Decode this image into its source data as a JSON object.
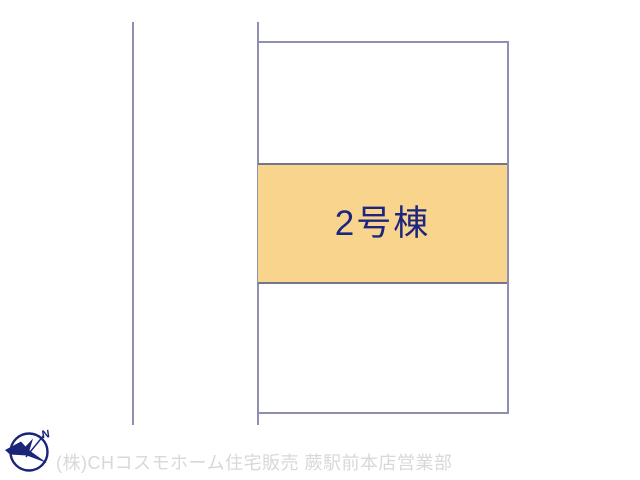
{
  "plan": {
    "lot_label": "2号棟",
    "compass": {
      "north_label": "N"
    },
    "watermark": "(株)CHコスモホーム住宅販売 蕨駅前本店営業部",
    "colors": {
      "line": "#8F8FB2",
      "band_border": "#75758C",
      "highlight_fill": "#F8D48D",
      "label_text": "#1C2680",
      "compass": "#1A2478",
      "watermark_text": "#D8D8D8"
    }
  }
}
